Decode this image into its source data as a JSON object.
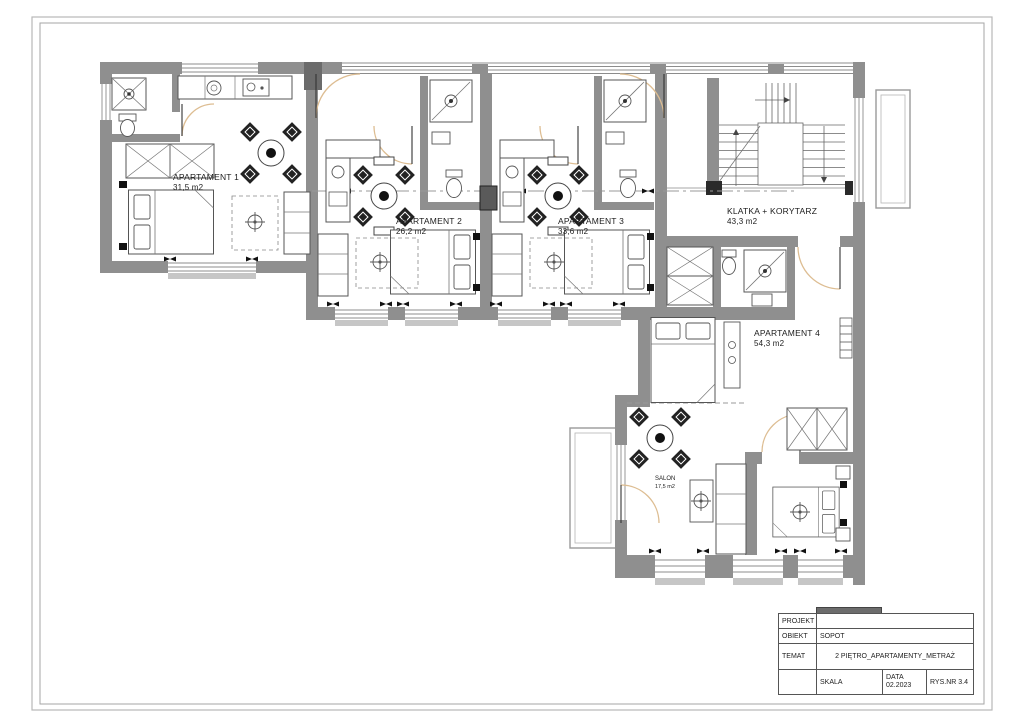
{
  "drawing": {
    "rooms": [
      {
        "name": "APARTAMENT 1",
        "area": "31,5 m2"
      },
      {
        "name": "APARTAMENT 2",
        "area": "26,2 m2"
      },
      {
        "name": "APARTAMENT 3",
        "area": "33,6 m2"
      },
      {
        "name": "KLATKA + KORYTARZ",
        "area": "43,3 m2"
      },
      {
        "name": "APARTAMENT 4",
        "area": "54,3 m2"
      },
      {
        "name": "SALON",
        "area": "17,5 m2"
      }
    ]
  },
  "title_block": {
    "projekt_label": "PROJEKT",
    "projekt_value": "",
    "obiekt_label": "OBIEKT",
    "obiekt_value": "SOPOT",
    "temat_label": "TEMAT",
    "temat_value": "2 PIĘTRO_APARTAMENTY_METRAŻ",
    "skala_label": "SKALA",
    "data_label": "DATA",
    "data_value": "02.2023",
    "rys_nr": "RYS.NR 3.4"
  },
  "colors": {
    "wall": "#8f8f8f",
    "wall_dark": "#6b6b6b",
    "line": "#555555",
    "door_arc": "#ddbd92",
    "accent_black": "#1a1a1a"
  }
}
